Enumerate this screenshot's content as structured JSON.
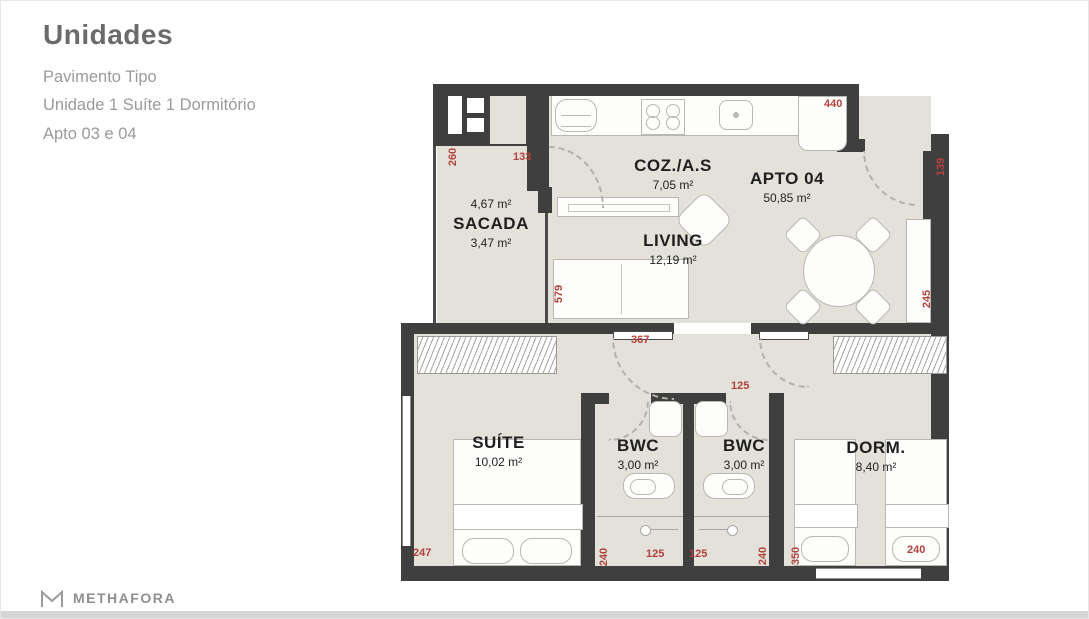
{
  "header": {
    "title": "Unidades",
    "subtitle_lines": [
      "Pavimento Tipo",
      "Unidade 1 Suíte 1 Dormitório",
      "Apto 03 e 04"
    ]
  },
  "footer": {
    "brand": "METHAFORA",
    "logo_icon": "methafora-m-icon"
  },
  "plan": {
    "rooms": [
      {
        "name": "SACADA",
        "area": "3,47 m²",
        "area_upper": "4,67 m²"
      },
      {
        "name": "COZ./A.S",
        "area": "7,05 m²"
      },
      {
        "name": "APTO 04",
        "area": "50,85 m²"
      },
      {
        "name": "LIVING",
        "area": "12,19 m²"
      },
      {
        "name": "SUÍTE",
        "area": "10,02 m²"
      },
      {
        "name": "BWC",
        "area": "3,00 m²"
      },
      {
        "name": "BWC",
        "area": "3,00 m²"
      },
      {
        "name": "DORM.",
        "area": "8,40 m²"
      }
    ],
    "dimensions": [
      "260",
      "133",
      "440",
      "139",
      "579",
      "245",
      "367",
      "125",
      "247",
      "240",
      "125",
      "125",
      "240",
      "350",
      "240"
    ],
    "colors": {
      "wall": "#3f3f3f",
      "floor": "#e3e1da",
      "dimension_text": "#b2423c"
    }
  }
}
